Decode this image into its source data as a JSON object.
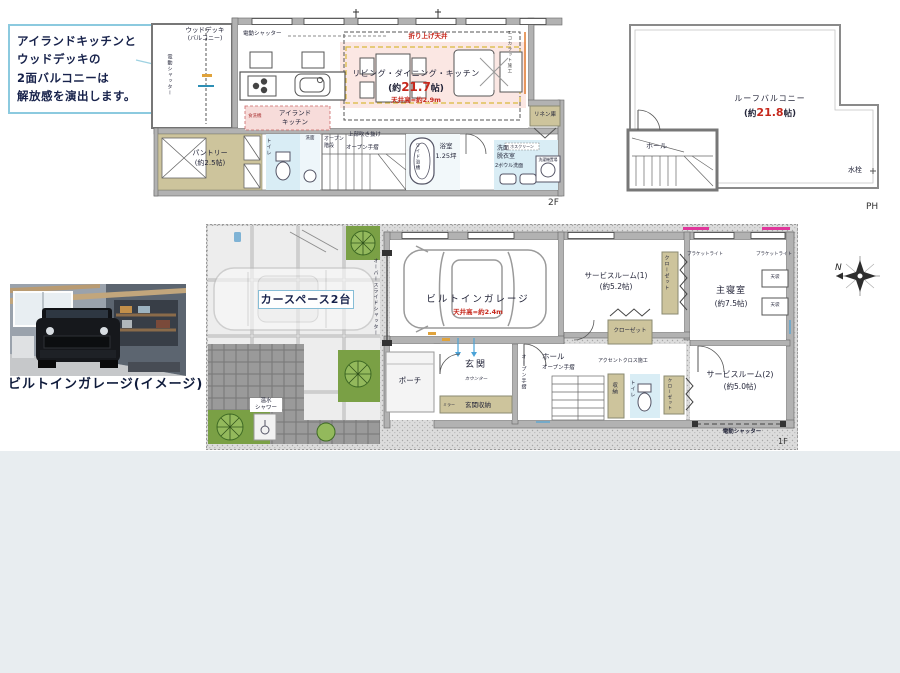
{
  "callout": {
    "line1": "アイランドキッチンと",
    "line2": "ウッドデッキの",
    "line3": "2面バルコニーは",
    "line4": "解放感を演出します。"
  },
  "floor2": {
    "label": "2F",
    "wood_deck": "ウッドデッキ",
    "wood_deck_sub": "(バルコニー)",
    "shutter_left": "電動シャッター",
    "shutter_top": "電動シャッター",
    "coffered": "折り上げ天井",
    "ldk": "リビング・ダイニング・キッチン",
    "ldk_size_pre": "(約",
    "ldk_size_val": "21.7",
    "ldk_size_post": "帖)",
    "ceiling": "天井高=約2.9m",
    "ecocarat": "エコカラット施工",
    "island1": "アイランド",
    "island2": "キッチン",
    "dishwasher": "食洗機",
    "pantry": "パントリー",
    "pantry_size": "(約2.5帖)",
    "toilet": "トイレ",
    "wash": "洗面",
    "stairs1": "オープン",
    "stairs2": "階段",
    "void": "上部吹き抜け",
    "handrail": "オープン手摺",
    "tub": "ワイド浴槽",
    "bath": "浴室",
    "bath_size": "1.25坪",
    "wash_room1": "洗面",
    "wash_room2": "脱衣室",
    "two_bowl": "2ボウル洗面",
    "hosu": "ホスクリーン",
    "linen": "リネン庫",
    "washer": "洗濯機置場"
  },
  "floorPH": {
    "label": "PH",
    "balcony": "ルーフバルコニー",
    "size_pre": "(約",
    "size_val": "21.8",
    "size_post": "帖)",
    "hall": "ホール",
    "faucet": "水栓"
  },
  "floor1": {
    "label": "1F",
    "car_space": "カースペース2台",
    "shower1": "温水",
    "shower2": "シャワー",
    "overslide": "オーバースライドシャッター",
    "garage": "ビルトインガレージ",
    "garage_ceiling": "天井高=約2.4m",
    "service1": "サービスルーム(1)",
    "service1_size": "(約5.2帖)",
    "closet1": "クローゼット",
    "bracket_left": "ブラケットライト",
    "bracket_right": "ブラケットライト",
    "master": "主寝室",
    "master_size": "(約7.5帖)",
    "tenbukuro1": "天袋",
    "tenbukuro2": "天袋",
    "closet_mid": "クローゼット",
    "porch": "ポーチ",
    "entrance": "玄関",
    "counter": "カウンター",
    "mirror": "ミラー",
    "entrance_storage": "玄関収納",
    "handrail_v": "オープン手摺",
    "hall": "ホール",
    "handrail_h": "オープン手摺",
    "accent": "アクセントクロス施工",
    "storage": "収納",
    "toilet": "トイレ",
    "closet2": "クローゼット",
    "service2": "サービスルーム(2)",
    "service2_size": "(約5.0帖)",
    "shutter_bottom": "電動シャッター"
  },
  "photo": {
    "caption": "ビルトインガレージ(イメージ)"
  },
  "compass": {
    "north": "N"
  }
}
